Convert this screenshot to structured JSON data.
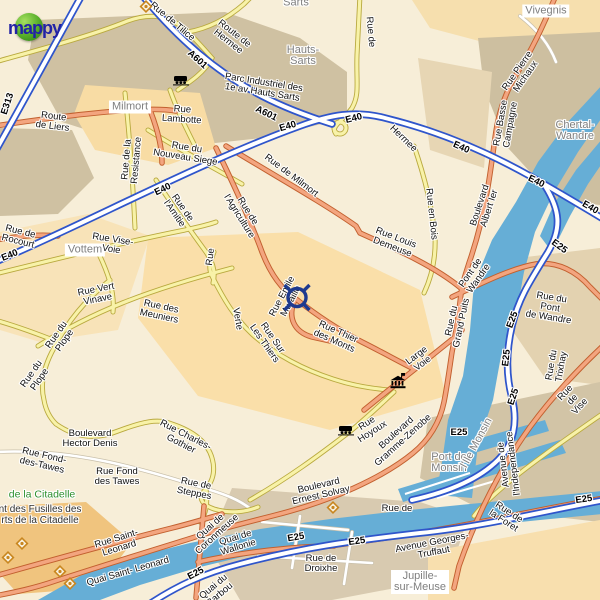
{
  "logo": {
    "text": "mappy"
  },
  "colors": {
    "water": "#66aed6",
    "motorway_blue": "#2f55cb",
    "road_orange": "#f3a57f",
    "road_yellow": "#f8f2a8",
    "marker_blue": "#1e3a8f",
    "poi_orange": "#c8861f",
    "park_green": "#2e8f2e",
    "place_gray": "#7f7f7f"
  },
  "marker": {
    "name": "destination-marker",
    "x": 297,
    "y": 300
  },
  "monument": {
    "name": "monument-icon",
    "x": 398,
    "y": 384
  },
  "stations": [
    {
      "name": "train-station-icon",
      "x": 181,
      "y": 82
    },
    {
      "name": "train-station-icon",
      "x": 346,
      "y": 432
    }
  ],
  "pois": [
    {
      "name": "poi-diamond-icon",
      "x": 146,
      "y": 9
    },
    {
      "name": "poi-diamond-icon",
      "x": 22,
      "y": 546
    },
    {
      "name": "poi-diamond-icon",
      "x": 8,
      "y": 560
    },
    {
      "name": "poi-diamond-icon",
      "x": 60,
      "y": 574
    },
    {
      "name": "poi-diamond-icon",
      "x": 70,
      "y": 586
    },
    {
      "name": "poi-diamond-icon",
      "x": 333,
      "y": 510
    }
  ],
  "labels": [
    {
      "name": "place-sarts-partial",
      "text": "Sarts",
      "x": 296,
      "y": 3,
      "rot": 0,
      "cls": "place"
    },
    {
      "name": "place-hauts-sarts",
      "text": "Hauts-\nSarts",
      "x": 303,
      "y": 56,
      "rot": 0,
      "cls": "place"
    },
    {
      "name": "place-milmort",
      "text": "Milmort",
      "x": 130,
      "y": 107,
      "rot": 0,
      "cls": "place boxed"
    },
    {
      "name": "place-vivegnis",
      "text": "Vivegnis",
      "x": 546,
      "y": 11,
      "rot": 0,
      "cls": "place boxed"
    },
    {
      "name": "place-chertal-wandre",
      "text": "Chertal-\nWandre",
      "x": 575,
      "y": 131,
      "rot": 0,
      "cls": "place"
    },
    {
      "name": "place-vottem",
      "text": "Vottem",
      "x": 85,
      "y": 250,
      "rot": 0,
      "cls": "place boxed"
    },
    {
      "name": "place-port-de-monsin",
      "text": "Port de\nMonsin",
      "x": 449,
      "y": 463,
      "rot": 0,
      "cls": "place"
    },
    {
      "name": "place-ile-monsin",
      "text": "l'Ile Monsin",
      "x": 477,
      "y": 443,
      "rot": -62,
      "cls": "place"
    },
    {
      "name": "place-jupille-sur-meuse",
      "text": "Jupille-\nsur-Meuse",
      "x": 420,
      "y": 582,
      "rot": 0,
      "cls": "place boxed"
    },
    {
      "name": "park-citadelle",
      "text": "de la    Citadelle",
      "x": 42,
      "y": 495,
      "rot": 0,
      "cls": "park"
    },
    {
      "name": "memorial-fusilles",
      "text": "nt des Fusilles des\nrts de la Citadelle",
      "x": 40,
      "y": 515,
      "rot": 0,
      "cls": "memorial"
    },
    {
      "name": "shield-e313",
      "text": "E313",
      "x": 8,
      "y": 104,
      "rot": -72,
      "cls": "mot"
    },
    {
      "name": "shield-a601-a",
      "text": "A601",
      "x": 197,
      "y": 60,
      "rot": 42,
      "cls": "mot"
    },
    {
      "name": "shield-a601-b",
      "text": "A601",
      "x": 266,
      "y": 114,
      "rot": 26,
      "cls": "mot"
    },
    {
      "name": "shield-e40-a",
      "text": "E40",
      "x": 288,
      "y": 127,
      "rot": -16,
      "cls": "mot"
    },
    {
      "name": "shield-e40-b",
      "text": "E40",
      "x": 354,
      "y": 119,
      "rot": -14,
      "cls": "mot"
    },
    {
      "name": "shield-e40-c",
      "text": "E40",
      "x": 461,
      "y": 148,
      "rot": 24,
      "cls": "mot"
    },
    {
      "name": "shield-e40-d",
      "text": "E40",
      "x": 536,
      "y": 182,
      "rot": 26,
      "cls": "mot"
    },
    {
      "name": "shield-e40-e",
      "text": "E40",
      "x": 590,
      "y": 208,
      "rot": 30,
      "cls": "mot"
    },
    {
      "name": "shield-e40-f",
      "text": "E40",
      "x": 10,
      "y": 256,
      "rot": -22,
      "cls": "mot"
    },
    {
      "name": "shield-e40-g",
      "text": "E40",
      "x": 163,
      "y": 190,
      "rot": -26,
      "cls": "mot"
    },
    {
      "name": "shield-e25-a",
      "text": "E25",
      "x": 559,
      "y": 247,
      "rot": 36,
      "cls": "mot"
    },
    {
      "name": "shield-e25-b",
      "text": "E25",
      "x": 513,
      "y": 320,
      "rot": -70,
      "cls": "mot"
    },
    {
      "name": "shield-e25-c",
      "text": "E25",
      "x": 507,
      "y": 358,
      "rot": -84,
      "cls": "mot"
    },
    {
      "name": "shield-e25-d",
      "text": "E25",
      "x": 514,
      "y": 397,
      "rot": -72,
      "cls": "mot"
    },
    {
      "name": "shield-e25-e",
      "text": "E25",
      "x": 459,
      "y": 433,
      "rot": 0,
      "cls": "mot"
    },
    {
      "name": "shield-e25-f",
      "text": "E25",
      "x": 296,
      "y": 538,
      "rot": -10,
      "cls": "mot"
    },
    {
      "name": "shield-e25-g",
      "text": "E25",
      "x": 357,
      "y": 542,
      "rot": -8,
      "cls": "mot"
    },
    {
      "name": "shield-e25-h",
      "text": "E25",
      "x": 196,
      "y": 574,
      "rot": -28,
      "cls": "mot"
    },
    {
      "name": "shield-e25-i",
      "text": "E25",
      "x": 584,
      "y": 500,
      "rot": -8,
      "cls": "mot"
    },
    {
      "name": "road-rue-de-tilice",
      "text": "Rue de  Tilice",
      "x": 172,
      "y": 22,
      "rot": 40,
      "cls": "road"
    },
    {
      "name": "road-route-de-hermee",
      "text": "Route de\nHermee",
      "x": 231,
      "y": 38,
      "rot": 38,
      "cls": "road"
    },
    {
      "name": "road-parc-industriel",
      "text": "Parc Industriel des\n1e av Hauts Sarts",
      "x": 263,
      "y": 88,
      "rot": 9,
      "cls": "road"
    },
    {
      "name": "road-hermee",
      "text": "Hermee",
      "x": 403,
      "y": 139,
      "rot": 44,
      "cls": "road"
    },
    {
      "name": "road-route-de-liers",
      "text": "Route\nde Liers",
      "x": 53,
      "y": 122,
      "rot": 7,
      "cls": "road"
    },
    {
      "name": "road-rue-lambotte",
      "text": "Rue\nLambotte",
      "x": 182,
      "y": 115,
      "rot": 4,
      "cls": "road"
    },
    {
      "name": "road-rue-de-hauts-sarts",
      "text": "Rue de",
      "x": 370,
      "y": 32,
      "rot": 85,
      "cls": "road"
    },
    {
      "name": "road-rue-de-la-resistance",
      "text": "Rue de la\nResistance",
      "x": 132,
      "y": 160,
      "rot": -85,
      "cls": "road"
    },
    {
      "name": "road-rue-du-nouveau-siege",
      "text": "Rue du\nNouveau Siege",
      "x": 186,
      "y": 153,
      "rot": 9,
      "cls": "road"
    },
    {
      "name": "road-rue-de-rocourt",
      "text": "Rue de\nRocourt",
      "x": 19,
      "y": 237,
      "rot": 14,
      "cls": "road"
    },
    {
      "name": "road-rue-de-l-amitie",
      "text": "Rue de\nl'Amitie",
      "x": 178,
      "y": 211,
      "rot": 55,
      "cls": "road"
    },
    {
      "name": "road-rue-vise-voie",
      "text": "Rue Vise-\nVoie",
      "x": 112,
      "y": 245,
      "rot": 9,
      "cls": "road"
    },
    {
      "name": "road-rue-partial",
      "text": "Rue",
      "x": 211,
      "y": 257,
      "rot": -83,
      "cls": "road"
    },
    {
      "name": "road-rue-de-l-agriculture",
      "text": "Rue de\nl'Agriculture",
      "x": 243,
      "y": 214,
      "rot": 58,
      "cls": "road"
    },
    {
      "name": "road-rue-de-milmort",
      "text": "Rue de   Milmort",
      "x": 291,
      "y": 176,
      "rot": 37,
      "cls": "road"
    },
    {
      "name": "road-rue-louis-demeuse",
      "text": "Rue Louis\nDemeuse",
      "x": 394,
      "y": 243,
      "rot": 21,
      "cls": "road"
    },
    {
      "name": "road-rue-en-bois",
      "text": "Rue en  Bois",
      "x": 431,
      "y": 214,
      "rot": 84,
      "cls": "road"
    },
    {
      "name": "road-rue-pierre-michaux",
      "text": "Rue Pierre\nMichaux",
      "x": 522,
      "y": 74,
      "rot": -55,
      "cls": "road"
    },
    {
      "name": "road-rue-basse-campagne",
      "text": "Rue Basse\nCampagne",
      "x": 506,
      "y": 124,
      "rot": -80,
      "cls": "road"
    },
    {
      "name": "road-boulevard-albert-ier",
      "text": "Boulevard\nAlbert Ier",
      "x": 485,
      "y": 207,
      "rot": -72,
      "cls": "road"
    },
    {
      "name": "road-pont-de-wandre",
      "text": "Pont de\nWandre",
      "x": 475,
      "y": 276,
      "rot": -55,
      "cls": "road"
    },
    {
      "name": "road-rue-du-grand-puits",
      "text": "Rue du\nGrand Puits",
      "x": 457,
      "y": 322,
      "rot": -78,
      "cls": "road"
    },
    {
      "name": "road-rue-du-pont-de-wandre",
      "text": "Rue du Pont\nde Wandre",
      "x": 550,
      "y": 308,
      "rot": 9,
      "cls": "road"
    },
    {
      "name": "road-rue-du-trixhay",
      "text": "Rue du\nTrixhay",
      "x": 557,
      "y": 366,
      "rot": -80,
      "cls": "road"
    },
    {
      "name": "road-rue-de-vise",
      "text": "Rue de   Vise",
      "x": 573,
      "y": 400,
      "rot": -47,
      "cls": "road"
    },
    {
      "name": "road-rue-vert-vinave",
      "text": "Rue Vert\nVinave",
      "x": 97,
      "y": 295,
      "rot": -11,
      "cls": "road"
    },
    {
      "name": "road-rue-des-meuniers",
      "text": "Rue des\nMeuniers",
      "x": 160,
      "y": 312,
      "rot": 12,
      "cls": "road"
    },
    {
      "name": "road-rue-du-plope-a",
      "text": "Rue du\nPlope",
      "x": 61,
      "y": 338,
      "rot": -55,
      "cls": "road"
    },
    {
      "name": "road-rue-du-plope-b",
      "text": "Rue du\nPlope",
      "x": 36,
      "y": 377,
      "rot": -55,
      "cls": "road"
    },
    {
      "name": "road-rue-verte",
      "text": "Verte",
      "x": 237,
      "y": 319,
      "rot": 80,
      "cls": "road"
    },
    {
      "name": "road-rue-sur-les-thiers",
      "text": "Rue Sur\nLes Thiers",
      "x": 268,
      "y": 341,
      "rot": 55,
      "cls": "road"
    },
    {
      "name": "road-rue-emile-muraille",
      "text": "Rue Emile\nMuraille",
      "x": 287,
      "y": 299,
      "rot": -62,
      "cls": "road"
    },
    {
      "name": "road-rue-thier-des-monts",
      "text": "Rue Thier\ndes Monts",
      "x": 336,
      "y": 337,
      "rot": 24,
      "cls": "road"
    },
    {
      "name": "road-large-voie",
      "text": "Large\nVoie",
      "x": 420,
      "y": 360,
      "rot": -37,
      "cls": "road"
    },
    {
      "name": "road-rue-hoyoux",
      "text": "Rue\nHoyoux",
      "x": 370,
      "y": 428,
      "rot": -33,
      "cls": "road"
    },
    {
      "name": "road-boulevard-gramme-zenobe",
      "text": "Boulevard\nGramme-Zenobe",
      "x": 400,
      "y": 437,
      "rot": -42,
      "cls": "road"
    },
    {
      "name": "road-boulevard-ernest-solvay",
      "text": "Boulevard\nErnest Solvay",
      "x": 320,
      "y": 491,
      "rot": -13,
      "cls": "road"
    },
    {
      "name": "road-boulevard-hector-denis",
      "text": "Boulevard\nHector Denis",
      "x": 90,
      "y": 439,
      "rot": 0,
      "cls": "road"
    },
    {
      "name": "road-rue-charles-gothier",
      "text": "Rue Charles-\nGothier",
      "x": 183,
      "y": 440,
      "rot": 27,
      "cls": "road"
    },
    {
      "name": "road-rue-fond-des-tawes-a",
      "text": "Rue Fond-\ndes-Tawes",
      "x": 43,
      "y": 461,
      "rot": 13,
      "cls": "road"
    },
    {
      "name": "road-rue-fond-des-tawes-b",
      "text": "Rue Fond\ndes Tawes",
      "x": 117,
      "y": 477,
      "rot": 0,
      "cls": "road"
    },
    {
      "name": "road-rue-de-steppes",
      "text": "Rue de\nSteppes",
      "x": 195,
      "y": 489,
      "rot": 11,
      "cls": "road"
    },
    {
      "name": "road-rue-saint-leonard",
      "text": "Rue Saint-\nLeonard",
      "x": 118,
      "y": 544,
      "rot": -17,
      "cls": "road"
    },
    {
      "name": "road-quai-saint-leonard",
      "text": "Quai Saint-  Leonard",
      "x": 128,
      "y": 572,
      "rot": -16,
      "cls": "road"
    },
    {
      "name": "road-quai-de-coronmeuse",
      "text": "Quai de\nCoronmeuse",
      "x": 214,
      "y": 531,
      "rot": -42,
      "cls": "road"
    },
    {
      "name": "road-quai-de-wallonie",
      "text": "Quai de\nWallonie",
      "x": 237,
      "y": 543,
      "rot": -17,
      "cls": "road"
    },
    {
      "name": "road-quai-du-barbou",
      "text": "Quai du\nBarbou",
      "x": 217,
      "y": 591,
      "rot": -40,
      "cls": "road"
    },
    {
      "name": "road-rue-de-droixhe",
      "text": "Rue de\nDroixhe",
      "x": 321,
      "y": 564,
      "rot": 0,
      "cls": "road"
    },
    {
      "name": "road-rue-de-monsin",
      "text": "Rue de",
      "x": 397,
      "y": 509,
      "rot": 0,
      "cls": "road"
    },
    {
      "name": "road-avenue-georges-truffaut",
      "text": "Avenue Georges-\nTruffaut",
      "x": 433,
      "y": 548,
      "rot": -11,
      "cls": "road"
    },
    {
      "name": "road-rue-de-la-foret",
      "text": "Rue de\nla Foret",
      "x": 506,
      "y": 517,
      "rot": 33,
      "cls": "road"
    },
    {
      "name": "road-avenue-de-l-independance",
      "text": "Avenue de\nl'Independance",
      "x": 509,
      "y": 464,
      "rot": -97,
      "cls": "road"
    }
  ]
}
